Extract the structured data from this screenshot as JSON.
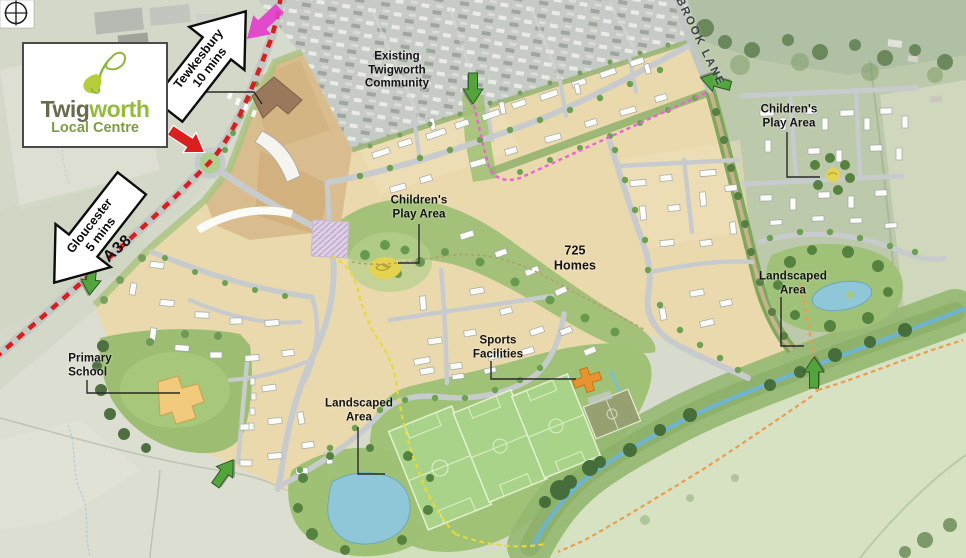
{
  "logo": {
    "part1": "Twig",
    "part2": "worth",
    "subtitle": "Local Centre"
  },
  "signs": {
    "tewkesbury": "Tewkesbury\n10 mins",
    "gloucester": "Gloucester\n5 mins"
  },
  "roads": {
    "a38": "A38",
    "brook_lane": "BROOK LANE"
  },
  "labels": {
    "existing_community": "Existing\nTwigworth\nCommunity",
    "play_area_central": "Children's\nPlay Area",
    "homes": "725\nHomes",
    "play_area_east": "Children's\nPlay Area",
    "landscaped_east": "Landscaped\nArea",
    "sports": "Sports\nFacilities",
    "landscaped_south": "Landscaped\nArea",
    "primary_school": "Primary\nSchool"
  },
  "icons": {
    "north": "compass-crosshair",
    "access_points": "green-arrow",
    "site_highlight": "magenta-arrow",
    "junction": "red-arrow"
  },
  "colors": {
    "a38_route": "#d91e1e",
    "pedestrian_route": "#ec62d8",
    "leisure_route": "#e8d83e",
    "riverside_route": "#eb9c4e",
    "access_arrow": "#53a43d",
    "highlight_arrow": "#e43ecb",
    "logo_green": "#95ba3e",
    "logo_olive": "#6b6b4b"
  }
}
